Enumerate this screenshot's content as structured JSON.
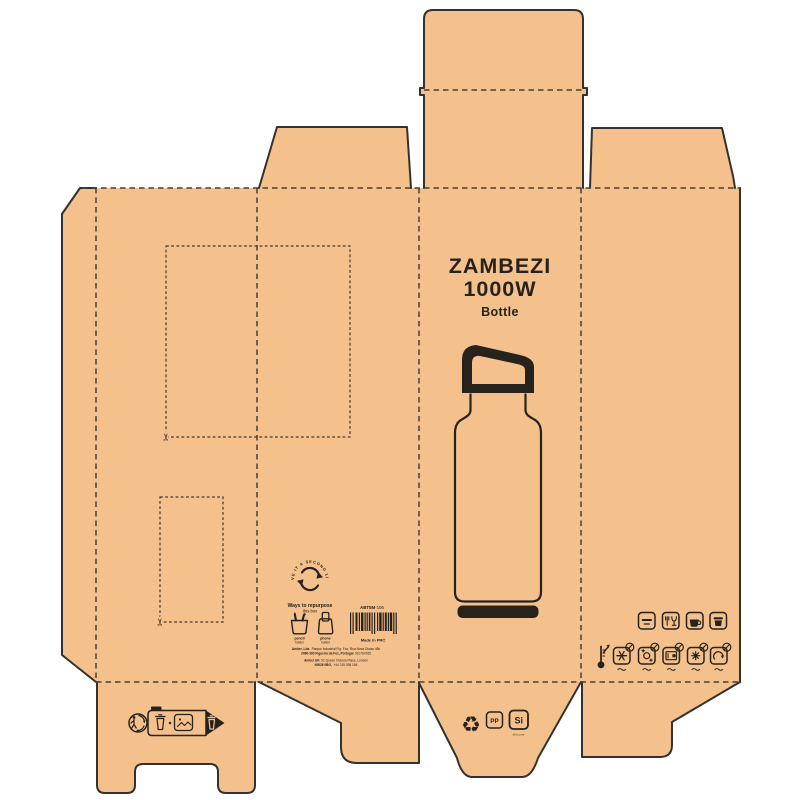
{
  "panel_front": {
    "title_line1": "ZAMBEZI",
    "title_line2": "1000W",
    "subtitle": "Bottle"
  },
  "repurpose": {
    "ring_text": "GIVE IT A SECOND LIFE",
    "heading": "Ways to repurpose",
    "subheading": "this box",
    "options": [
      {
        "bold": "pencil",
        "rest": "holder"
      },
      {
        "bold": "phone",
        "rest": "holder"
      }
    ]
  },
  "sku": {
    "code_bold": "ABT5M",
    "code_rest": "-106",
    "made_in": "Made in PRC"
  },
  "address": {
    "line1_bold": "Amber, Lda.",
    "line1_rest": "Parque Industrial Fig. Foz, Rua Nova Olaias 48b",
    "line2_bold": "3080-360 Figueira da Foz, Portugal",
    "line2_rest": "910764765",
    "line3_bold": "Amber UK",
    "line3_rest": "51 Queen Victoria Place, London",
    "line4_bold": "NW26 0BG,",
    "line4_rest": "+44 745 098 166"
  },
  "materials": {
    "pp": "PP",
    "si": "Si",
    "si_caption": "silicone"
  },
  "icons": {
    "scissors_char": "✂",
    "recycle_char": "♻",
    "care_top": [
      "sealed-lid-icon",
      "food-safe-icon",
      "hot-drink-icon",
      "cold-drink-icon"
    ],
    "care_bottom": [
      "no-freezer-icon",
      "no-dishwasher-icon",
      "no-microwave-icon",
      "no-frost-icon",
      "no-rinse-icon"
    ],
    "extras": [
      "thermometer-icon",
      "triman-icon",
      "sorting-info-icon",
      "recycle-loop-icon",
      "pencil-holder-icon",
      "phone-holder-icon",
      "second-life-arrows-icon"
    ]
  },
  "colors": {
    "kraft": "#f4c18c",
    "cut_line": "#35322d",
    "fold_line": "#474138",
    "print": "#27221c",
    "bg": "#ffffff"
  }
}
